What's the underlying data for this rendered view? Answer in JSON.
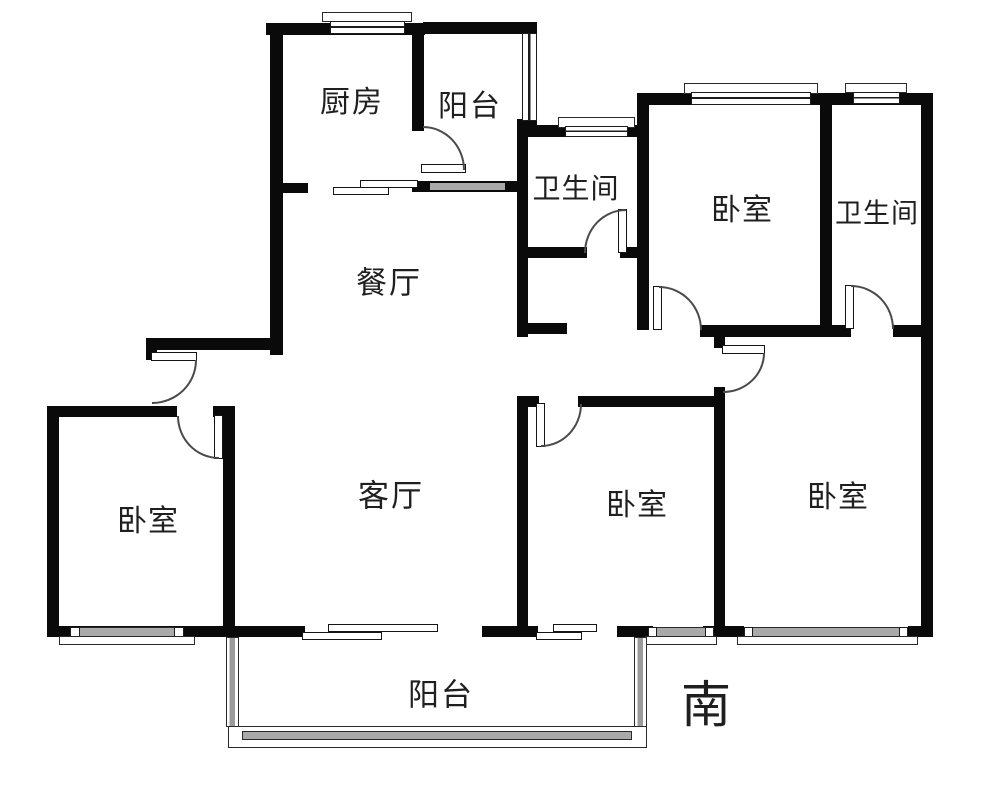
{
  "plan": {
    "type": "apartment-floor-plan",
    "rooms": {
      "kitchen": {
        "label": "厨房"
      },
      "balcony_top": {
        "label": "阳台"
      },
      "bathroom_middle": {
        "label": "卫生间"
      },
      "bedroom_top": {
        "label": "卧室"
      },
      "bathroom_right": {
        "label": "卫生间"
      },
      "dining_room": {
        "label": "餐厅"
      },
      "bedroom_left": {
        "label": "卧室"
      },
      "living_room": {
        "label": "客厅"
      },
      "bedroom_center": {
        "label": "卧室"
      },
      "bedroom_right": {
        "label": "卧室"
      },
      "balcony_bottom": {
        "label": "阳台"
      }
    },
    "compass": {
      "south": "南"
    },
    "colors": {
      "wall": "#0a0a0a",
      "window_band": "#a9a9a9",
      "background": "#ffffff",
      "door_arc": "#4a4a4a"
    }
  }
}
